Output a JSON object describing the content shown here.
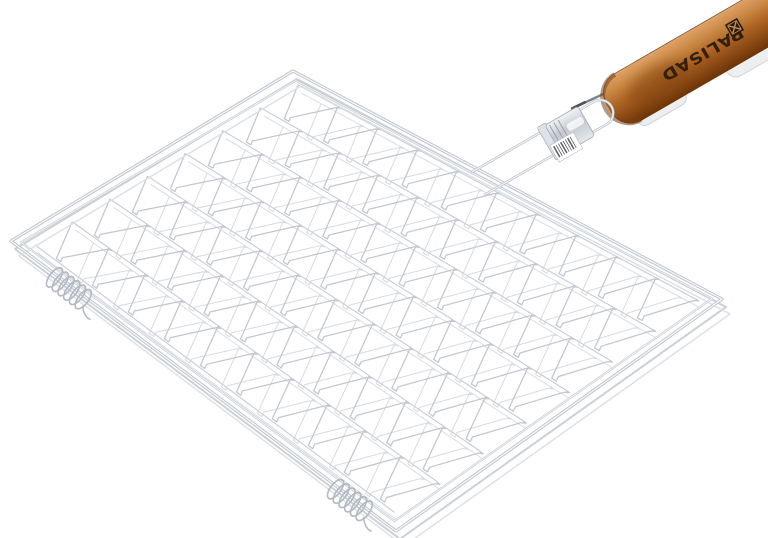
{
  "scene": {
    "type": "product-photo",
    "subject": "chrome wire barbecue grill grate with wooden handle",
    "background": "#ffffff"
  },
  "canvas": {
    "width": 768,
    "height": 538
  },
  "brand": {
    "name": "PALISAD",
    "text_color": "#33200b",
    "logo_color": "#2c1a06",
    "logo_accent": "#c09058"
  },
  "frame": {
    "corners": {
      "top": [
        293,
        71
      ],
      "right": [
        722,
        299
      ],
      "bottom": [
        396,
        531
      ],
      "left": [
        11,
        241
      ]
    },
    "outer_stroke": "#b9c0c8",
    "core_stroke": "#f4f6f8",
    "inner_stroke": "#c3c9d0",
    "inner_inset": 10,
    "thickness_rails": [
      {
        "offset": [
          4,
          8
        ],
        "color": "#ccd1d7",
        "width": 2.0
      },
      {
        "offset": [
          8,
          15
        ],
        "color": "#dde1e5",
        "width": 1.5
      }
    ]
  },
  "mesh": {
    "bands": 7,
    "teeth": 10,
    "shear": 0.55,
    "inset": 0.035,
    "notch_u": 0.011,
    "notch_v": 0.1,
    "top_stroke": "#c1c7cf",
    "top_width": 1.25,
    "bottom_stroke": "#d8dce1",
    "bottom_width": 1.05,
    "bottom_layer_offset": [
      3,
      8
    ],
    "boundary_stroke": "#c7cdd4"
  },
  "coils": {
    "edge": "left-bottom",
    "positions_t": [
      0.155,
      0.885
    ],
    "loops": 6,
    "loop_spacing": 7.2,
    "rx": 5.2,
    "ry": 11.5,
    "angle_deg": 37,
    "stroke": "#b2b9c1",
    "perp_shift": 3
  },
  "handle_assembly": {
    "origin": [
      479,
      183
    ],
    "angle_deg": -30,
    "loop": {
      "half_gap": 13,
      "length": 140,
      "bend_radius": 13,
      "stroke": "#bcc3ca",
      "core": "#f4f6f8"
    },
    "sleeve": {
      "x": 86,
      "y": -17,
      "w": 38,
      "h": 34,
      "collar_x": 78,
      "fill_light": "#f2f4f6",
      "fill_mid": "#c3c9cf",
      "fill_back": "#e6e9ec",
      "stroke": "#a8afb6",
      "groove": "#9aa2aa"
    },
    "barcode": {
      "x": 80,
      "y": 3,
      "w": 27,
      "h": 19,
      "bars": 8,
      "bar_color": "#5a5e63",
      "fill": "#ffffff",
      "stroke": "#b5bac0"
    },
    "rod": {
      "x1": 118,
      "y1": -18,
      "x2": 162,
      "y2": -14,
      "color": "#7d8287",
      "tip_color": "#4e5358"
    },
    "under_metal": [
      {
        "x": 168,
        "y": 18,
        "w": 55,
        "h": 16,
        "r": 8
      },
      {
        "x": 270,
        "y": 16,
        "w": 60,
        "h": 22,
        "r": 11
      }
    ],
    "under_metal_fill": "#eceef0",
    "under_metal_stroke": "#ccd1d6",
    "wood": {
      "x": 150,
      "y": -27,
      "w": 232,
      "h": 54,
      "r": 22,
      "grad": [
        "#e0a368",
        "#c98845",
        "#b06524",
        "#8f4c16",
        "#6b3408"
      ],
      "edge_stroke": "#6e3a10",
      "base_rim": "#7a3f14",
      "shade_color": "#7c430f"
    },
    "label": {
      "text_x": 258,
      "text_y": 0,
      "font_size": 15.5,
      "text_length": 92,
      "logo_x": 292,
      "logo_y": -14,
      "logo_size": 14
    }
  }
}
